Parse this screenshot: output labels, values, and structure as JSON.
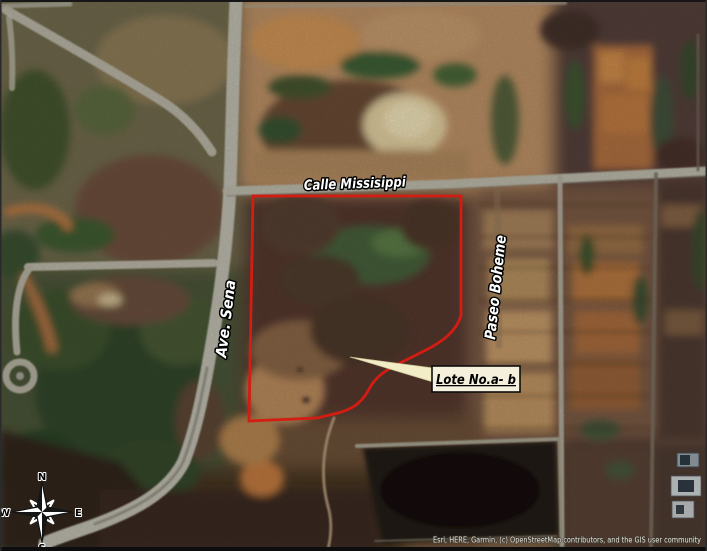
{
  "map": {
    "streets": {
      "calle_missisippi": "Calle Missisippi",
      "ave_sena": "Ave. Sena",
      "paseo_boheme": "Paseo Boheme"
    },
    "parcel": {
      "label": "Lote No.a- b",
      "outline_color": "#d41c12"
    },
    "compass": {
      "n": "N",
      "e": "E",
      "s": "S",
      "w": "W"
    },
    "attribution": "Esri, HERE, Garmin, (c) OpenStreetMap contributors, and the GIS user community",
    "colors": {
      "road": "#bcbaaa",
      "callout_bg": "#f4f0dc",
      "street_label_fill": "#ffffff",
      "street_label_halo": "#000000"
    }
  }
}
